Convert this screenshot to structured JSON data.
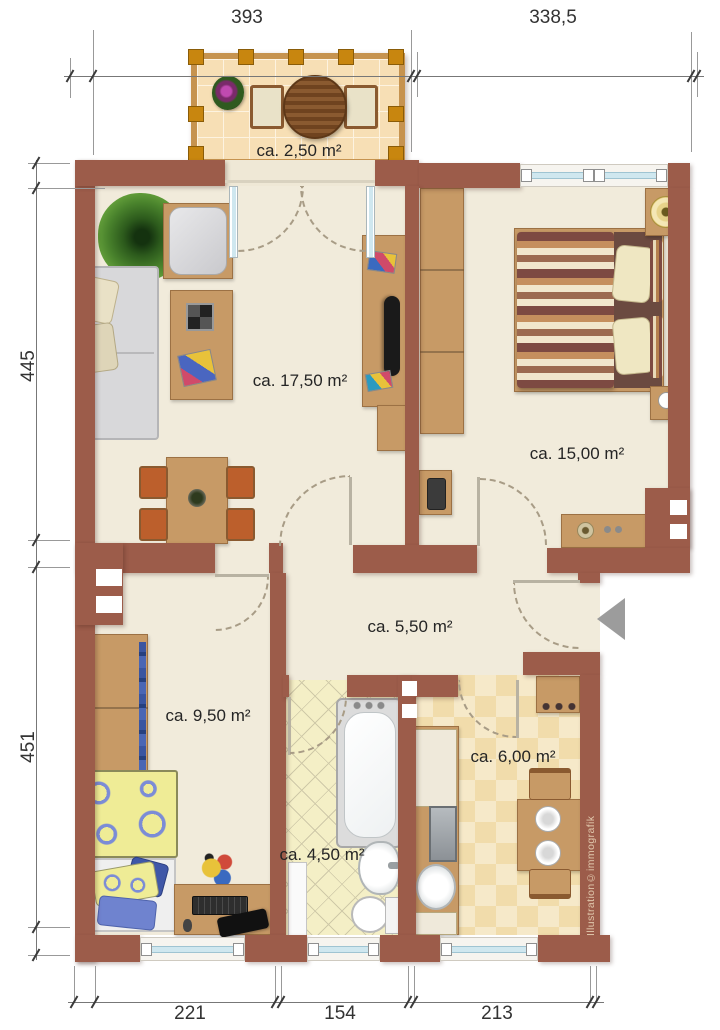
{
  "plan": {
    "watermark": "Illustration©immografik",
    "entrance_arrow_direction": "left",
    "colors": {
      "wall": "#9c5c4a",
      "floor": "#f1ebdb",
      "balcony_tile": "#f7dfb5",
      "bath_tile": "#f4efc6",
      "kitchen_tile_a": "#f6e9c9",
      "kitchen_tile_b": "#f1dcab",
      "wood": "#c79a66",
      "chair_cushion": "#bc5f2c",
      "window_glass": "#cfe7ef",
      "entrance_arrow": "#9c9c9c",
      "label_text": "#252525",
      "dimension_text": "#333333"
    },
    "rooms": [
      {
        "id": "balcony",
        "area_label": "ca. 2,50 m²"
      },
      {
        "id": "living-room",
        "area_label": "ca. 17,50 m²"
      },
      {
        "id": "bedroom",
        "area_label": "ca. 15,00 m²"
      },
      {
        "id": "hallway",
        "area_label": "ca. 5,50 m²"
      },
      {
        "id": "kids-room",
        "area_label": "ca. 9,50 m²"
      },
      {
        "id": "bathroom",
        "area_label": "ca. 4,50 m²"
      },
      {
        "id": "kitchen",
        "area_label": "ca. 6,00 m²"
      }
    ],
    "dimensions": {
      "top": [
        {
          "value": "393"
        },
        {
          "value": "338,5"
        }
      ],
      "left": [
        {
          "value": "445"
        },
        {
          "value": "451"
        }
      ],
      "bottom": [
        {
          "value": "221"
        },
        {
          "value": "154"
        },
        {
          "value": "213"
        }
      ]
    }
  }
}
